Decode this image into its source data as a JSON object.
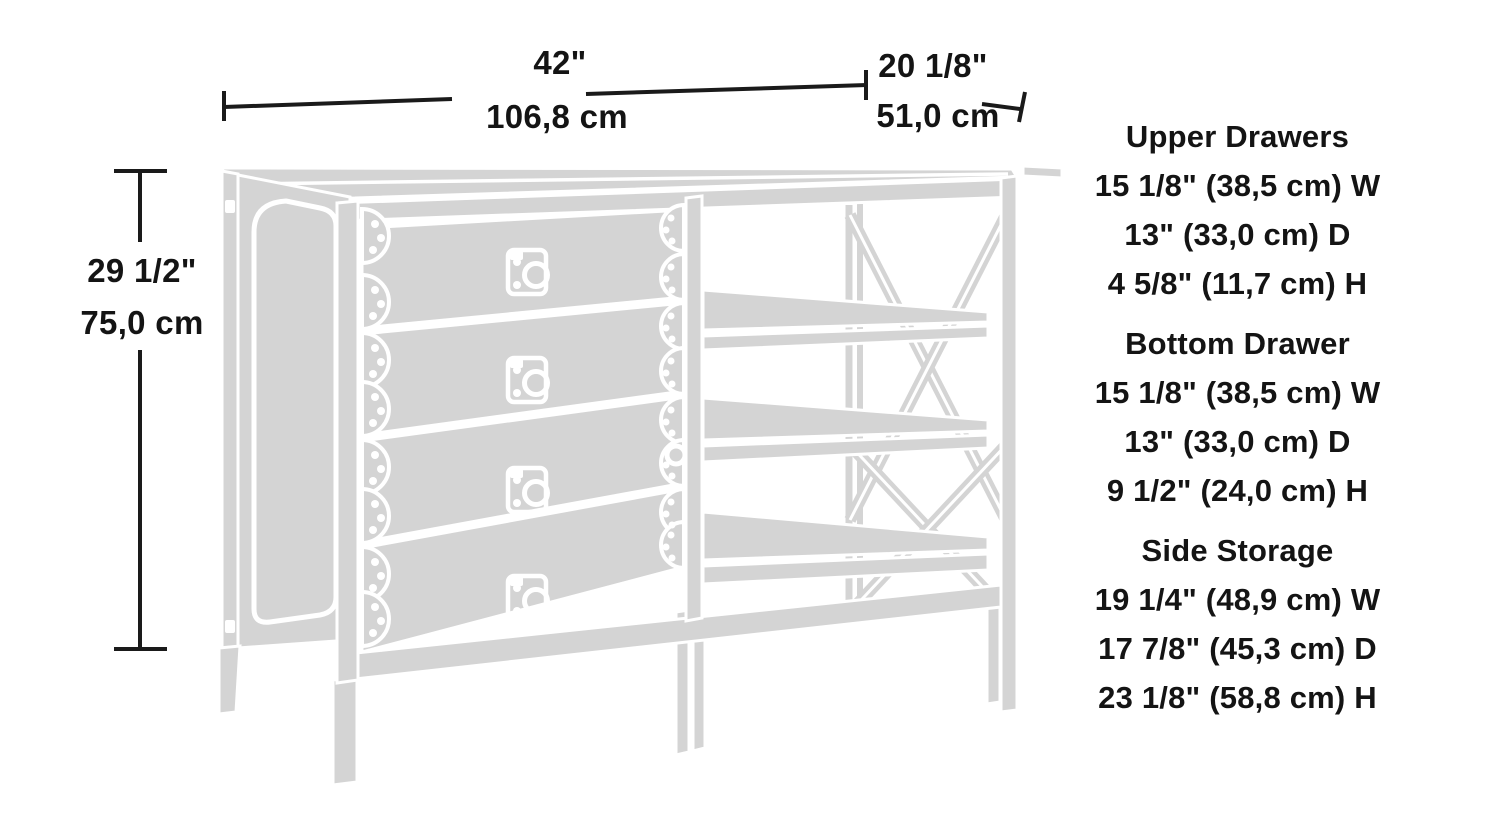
{
  "dimensions": {
    "width": {
      "inches": "42\"",
      "cm": "106,8 cm"
    },
    "depth": {
      "inches": "20 1/8\"",
      "cm": "51,0 cm"
    },
    "height": {
      "inches": "29 1/2\"",
      "cm": "75,0 cm"
    }
  },
  "specs": [
    {
      "title": "Upper Drawers",
      "lines": [
        "15 1/8\" (38,5 cm) W",
        "13\" (33,0 cm) D",
        "4 5/8\" (11,7 cm) H"
      ]
    },
    {
      "title": "Bottom Drawer",
      "lines": [
        "15 1/8\" (38,5 cm) W",
        "13\" (33,0 cm) D",
        "9 1/2\" (24,0 cm) H"
      ]
    },
    {
      "title": "Side Storage",
      "lines": [
        "19 1/4\" (48,9 cm) W",
        "17 7/8\" (45,3 cm) D",
        "23 1/8\" (58,8 cm) H"
      ]
    }
  ],
  "colors": {
    "furniture_fill": "#d4d4d4",
    "furniture_outline": "#ffffff",
    "dimension_line": "#1a1a1a",
    "text": "#141414",
    "background": "#ffffff"
  }
}
